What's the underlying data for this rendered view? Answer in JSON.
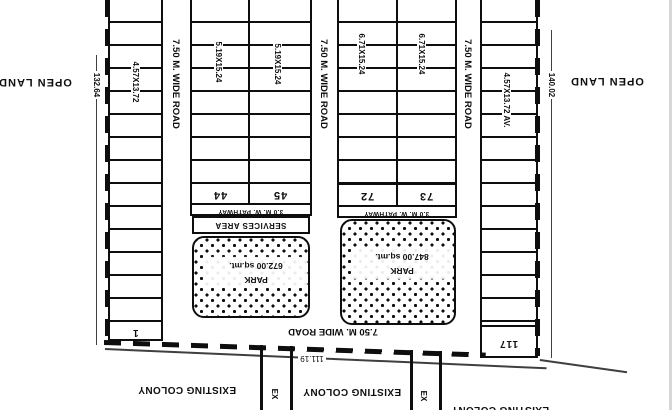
{
  "surroundings": {
    "open_land_left": "OPEN LAND",
    "open_land_right": "OPEN LAND",
    "existing_colony_1": "EXISTING COLONY",
    "existing_colony_2": "EXISTING COLONY",
    "existing_colony_3": "EXISTING COLONY",
    "ex_road_1": "EX",
    "ex_road_2": "EX"
  },
  "dimensions": {
    "left": "132.64",
    "right": "140.02",
    "bottom": "111.19"
  },
  "roads": {
    "road_1": "7.50 M. WIDE ROAD",
    "road_2": "7.50 M. WIDE ROAD",
    "road_3": "7.50 M. WIDE ROAD",
    "road_bottom": "7.50 M. WIDE ROAD"
  },
  "plot_columns": {
    "col_a": {
      "size_label": "4.57X13.72",
      "plot_no": "1"
    },
    "col_b1": {
      "size_label": "5.19X15.24",
      "plot_no": "44"
    },
    "col_b2": {
      "size_label": "5.19X15.24",
      "plot_no": "45"
    },
    "col_c1": {
      "size_label": "6.71X15.24",
      "plot_no": "72"
    },
    "col_c2": {
      "size_label": "6.71X15.24",
      "plot_no": "73"
    },
    "col_d": {
      "size_label": "4.57X13.72 AV.",
      "plot_no": "117"
    }
  },
  "amenities": {
    "pathway_b": "3.0 M. W. PATHWAY",
    "pathway_c": "3.0 M. W. PATHWAY",
    "services_area": "SERVICES AREA",
    "park_b": {
      "name": "PARK",
      "area": "672.00 sq.mt."
    },
    "park_c": {
      "name": "PARK",
      "area": "847.00 sq.mt."
    }
  },
  "colors": {
    "line": "#0e0e0e",
    "background": "#ffffff"
  }
}
